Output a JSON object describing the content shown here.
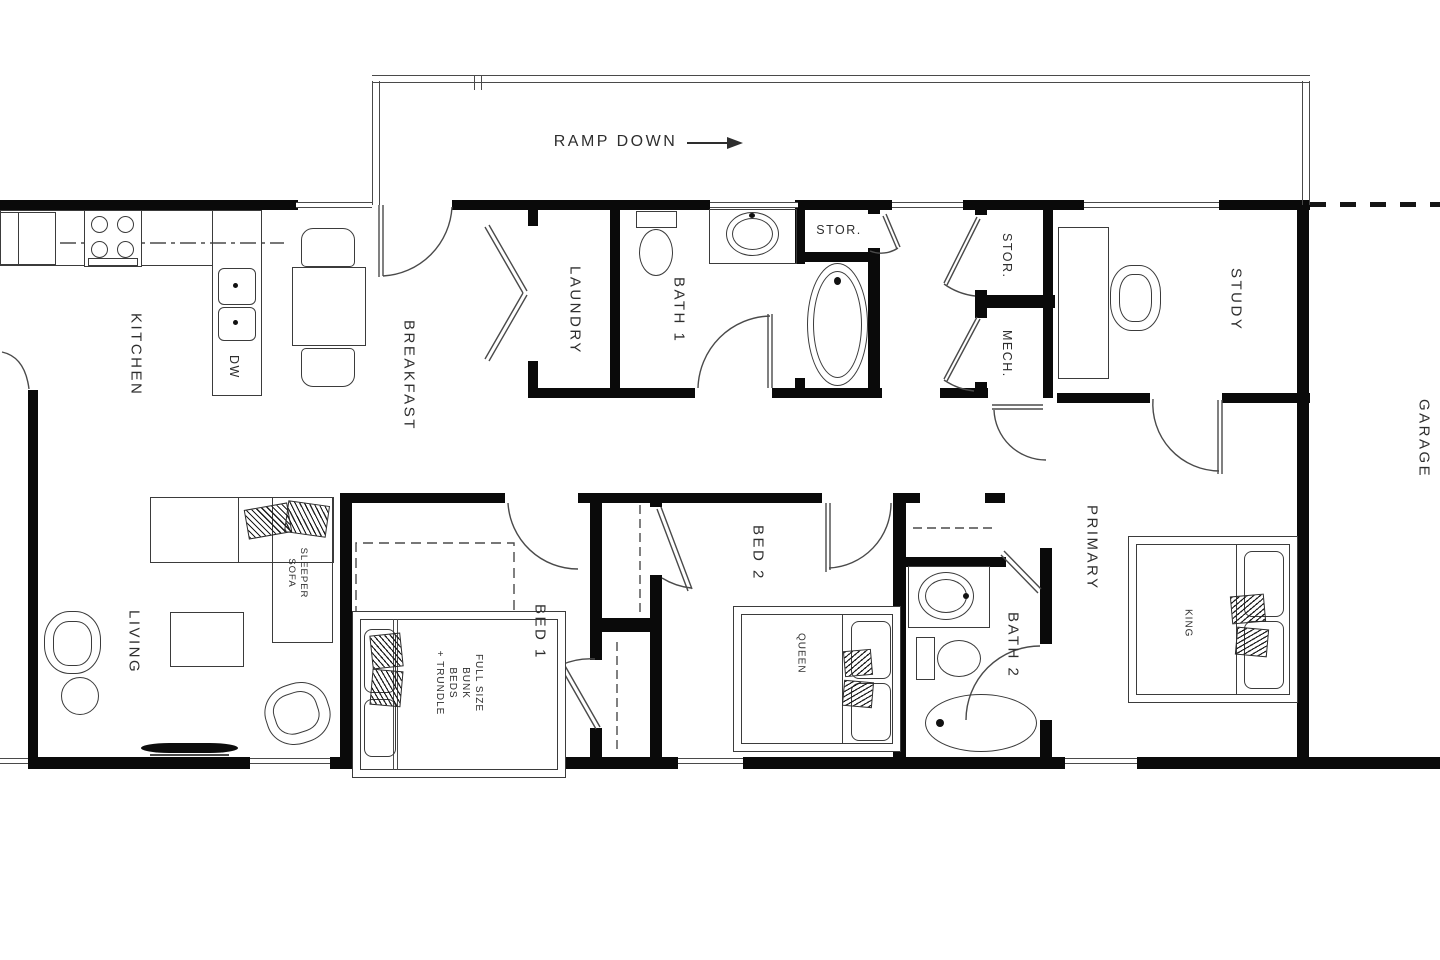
{
  "title": "Residential floor plan",
  "colors": {
    "wall": "#0a0a0a",
    "line": "#444444",
    "text": "#2e2e2e",
    "background": "#ffffff"
  },
  "annotations": {
    "ramp": "RAMP DOWN",
    "arrow_icon": "right-arrow"
  },
  "rooms": {
    "kitchen": "KITCHEN",
    "breakfast": "BREAKFAST",
    "living": "LIVING",
    "laundry": "LAUNDRY",
    "bath1": "BATH 1",
    "stor_tub": "STOR.",
    "stor_closet": "STOR.",
    "mech": "MECH.",
    "study": "STUDY",
    "garage": "GARAGE",
    "bed1": "BED 1",
    "bed2": "BED 2",
    "primary": "PRIMARY",
    "bath2": "BATH 2"
  },
  "fixtures": {
    "dishwasher": "DW",
    "sleeper_sofa": "SLEEPER\nSOFA",
    "bunk_beds": "FULL SIZE\nBUNK BEDS\n+ TRUNDLE",
    "queen_bed": "QUEEN",
    "king_bed": "KING"
  }
}
